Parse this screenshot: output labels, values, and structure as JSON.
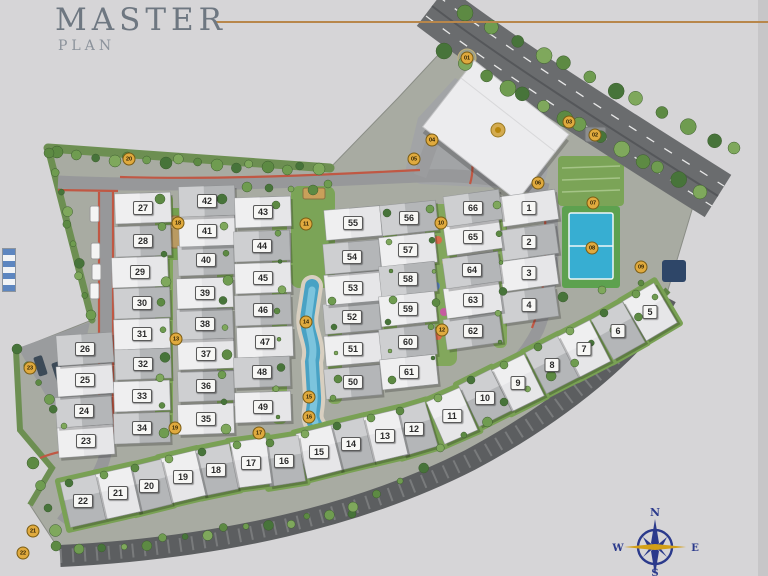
{
  "title": {
    "heading": "MASTER",
    "subheading": "PLAN"
  },
  "compass": {
    "north": "N",
    "south": "S",
    "east": "E",
    "west": "W"
  },
  "colors": {
    "background": "#d6d5d7",
    "accent_gold": "#b8874b",
    "boundary_red": "#c05844",
    "road_gray": "#97989a",
    "dark_road": "#5c5e60",
    "lawn_green": "#7ba457",
    "pool_blue": "#49a2c4",
    "tennis_blue": "#37aed2",
    "marker_gold": "#e0aa3e",
    "compass_navy": "#2b3a8c",
    "roof_light": "#e6e6e8",
    "roof_dark": "#b4b6b8"
  },
  "units": [
    {
      "n": "1",
      "x": 529,
      "y": 208
    },
    {
      "n": "2",
      "x": 529,
      "y": 242
    },
    {
      "n": "3",
      "x": 529,
      "y": 273
    },
    {
      "n": "4",
      "x": 529,
      "y": 305
    },
    {
      "n": "5",
      "x": 650,
      "y": 312
    },
    {
      "n": "6",
      "x": 618,
      "y": 331
    },
    {
      "n": "7",
      "x": 584,
      "y": 349
    },
    {
      "n": "8",
      "x": 552,
      "y": 365
    },
    {
      "n": "9",
      "x": 518,
      "y": 383
    },
    {
      "n": "10",
      "x": 485,
      "y": 398
    },
    {
      "n": "11",
      "x": 452,
      "y": 416
    },
    {
      "n": "12",
      "x": 414,
      "y": 429
    },
    {
      "n": "13",
      "x": 385,
      "y": 436
    },
    {
      "n": "14",
      "x": 351,
      "y": 444
    },
    {
      "n": "15",
      "x": 319,
      "y": 452
    },
    {
      "n": "16",
      "x": 284,
      "y": 461
    },
    {
      "n": "17",
      "x": 251,
      "y": 463
    },
    {
      "n": "18",
      "x": 216,
      "y": 470
    },
    {
      "n": "19",
      "x": 183,
      "y": 477
    },
    {
      "n": "20",
      "x": 149,
      "y": 486
    },
    {
      "n": "21",
      "x": 118,
      "y": 493
    },
    {
      "n": "22",
      "x": 83,
      "y": 501
    },
    {
      "n": "23",
      "x": 86,
      "y": 441
    },
    {
      "n": "24",
      "x": 84,
      "y": 411
    },
    {
      "n": "25",
      "x": 85,
      "y": 380
    },
    {
      "n": "26",
      "x": 85,
      "y": 349
    },
    {
      "n": "27",
      "x": 143,
      "y": 208
    },
    {
      "n": "28",
      "x": 143,
      "y": 241
    },
    {
      "n": "29",
      "x": 140,
      "y": 272
    },
    {
      "n": "30",
      "x": 142,
      "y": 303
    },
    {
      "n": "31",
      "x": 142,
      "y": 334
    },
    {
      "n": "32",
      "x": 143,
      "y": 364
    },
    {
      "n": "33",
      "x": 142,
      "y": 396
    },
    {
      "n": "34",
      "x": 142,
      "y": 428
    },
    {
      "n": "35",
      "x": 206,
      "y": 419
    },
    {
      "n": "36",
      "x": 206,
      "y": 386
    },
    {
      "n": "37",
      "x": 206,
      "y": 354
    },
    {
      "n": "38",
      "x": 205,
      "y": 324
    },
    {
      "n": "39",
      "x": 205,
      "y": 293
    },
    {
      "n": "40",
      "x": 206,
      "y": 260
    },
    {
      "n": "41",
      "x": 207,
      "y": 231
    },
    {
      "n": "42",
      "x": 207,
      "y": 201
    },
    {
      "n": "43",
      "x": 263,
      "y": 212
    },
    {
      "n": "44",
      "x": 262,
      "y": 246
    },
    {
      "n": "45",
      "x": 263,
      "y": 278
    },
    {
      "n": "46",
      "x": 263,
      "y": 310
    },
    {
      "n": "47",
      "x": 265,
      "y": 342
    },
    {
      "n": "48",
      "x": 262,
      "y": 372
    },
    {
      "n": "49",
      "x": 263,
      "y": 407
    },
    {
      "n": "50",
      "x": 353,
      "y": 382
    },
    {
      "n": "51",
      "x": 353,
      "y": 349
    },
    {
      "n": "52",
      "x": 352,
      "y": 317
    },
    {
      "n": "53",
      "x": 353,
      "y": 288
    },
    {
      "n": "54",
      "x": 352,
      "y": 257
    },
    {
      "n": "55",
      "x": 353,
      "y": 223
    },
    {
      "n": "56",
      "x": 409,
      "y": 218
    },
    {
      "n": "57",
      "x": 408,
      "y": 250
    },
    {
      "n": "58",
      "x": 408,
      "y": 279
    },
    {
      "n": "59",
      "x": 408,
      "y": 309
    },
    {
      "n": "60",
      "x": 408,
      "y": 342
    },
    {
      "n": "61",
      "x": 409,
      "y": 372
    },
    {
      "n": "62",
      "x": 473,
      "y": 331
    },
    {
      "n": "63",
      "x": 473,
      "y": 300
    },
    {
      "n": "64",
      "x": 472,
      "y": 270
    },
    {
      "n": "65",
      "x": 473,
      "y": 237
    },
    {
      "n": "66",
      "x": 473,
      "y": 208
    }
  ],
  "amenity_markers": [
    {
      "label": "01",
      "x": 467,
      "y": 58
    },
    {
      "label": "02",
      "x": 595,
      "y": 135
    },
    {
      "label": "03",
      "x": 569,
      "y": 122
    },
    {
      "label": "04",
      "x": 432,
      "y": 140
    },
    {
      "label": "05",
      "x": 414,
      "y": 159
    },
    {
      "label": "06",
      "x": 538,
      "y": 183
    },
    {
      "label": "07",
      "x": 593,
      "y": 203
    },
    {
      "label": "08",
      "x": 592,
      "y": 248
    },
    {
      "label": "09",
      "x": 641,
      "y": 267
    },
    {
      "label": "10",
      "x": 441,
      "y": 223
    },
    {
      "label": "11",
      "x": 306,
      "y": 224
    },
    {
      "label": "12",
      "x": 442,
      "y": 330
    },
    {
      "label": "13",
      "x": 176,
      "y": 339
    },
    {
      "label": "14",
      "x": 306,
      "y": 322
    },
    {
      "label": "15",
      "x": 309,
      "y": 397
    },
    {
      "label": "16",
      "x": 309,
      "y": 417
    },
    {
      "label": "17",
      "x": 259,
      "y": 433
    },
    {
      "label": "18",
      "x": 178,
      "y": 223
    },
    {
      "label": "19",
      "x": 175,
      "y": 428
    },
    {
      "label": "20",
      "x": 129,
      "y": 159
    },
    {
      "label": "21",
      "x": 33,
      "y": 531
    },
    {
      "label": "22",
      "x": 23,
      "y": 553
    },
    {
      "label": "23",
      "x": 30,
      "y": 368
    }
  ]
}
